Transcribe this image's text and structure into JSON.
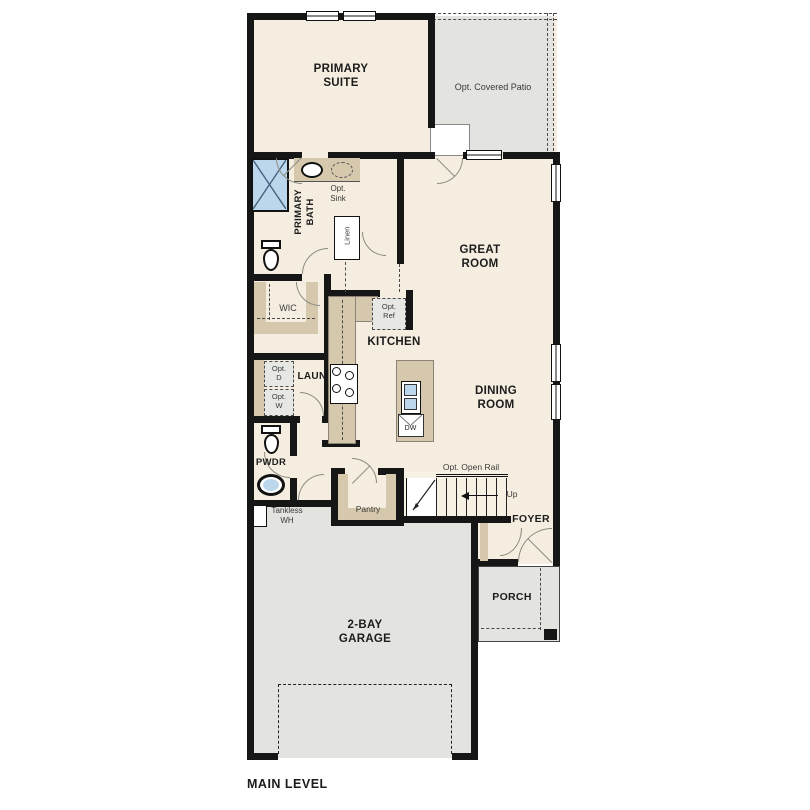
{
  "title": "MAIN LEVEL",
  "colors": {
    "floor_cream": "#f5eee0",
    "concrete_gray": "#e3e3e0",
    "cabinet_tan": "#d5c8ad",
    "fixture_blue": "#bcd7ec",
    "wall_black": "#161616"
  },
  "rooms": {
    "primary_suite": "PRIMARY\nSUITE",
    "primary_bath": "PRIMARY\nBATH",
    "wic": "WIC",
    "great_room": "GREAT\nROOM",
    "kitchen": "KITCHEN",
    "dining_room": "DINING\nROOM",
    "laundry": "LAUN",
    "powder": "PWDR",
    "pantry": "Pantry",
    "linen": "Linen",
    "foyer": "FOYER",
    "porch": "PORCH",
    "garage": "2-BAY\nGARAGE"
  },
  "annotations": {
    "opt_covered_patio": "Opt. Covered Patio",
    "opt_sink": "Opt.\nSink",
    "opt_ref": "Opt.\nRef",
    "opt_dryer": "Opt.\nD",
    "opt_washer": "Opt.\nW",
    "opt_open_rail": "Opt. Open Rail",
    "up": "Up",
    "tankless_wh": "Tankless\nWH",
    "dishwasher": "DW"
  }
}
